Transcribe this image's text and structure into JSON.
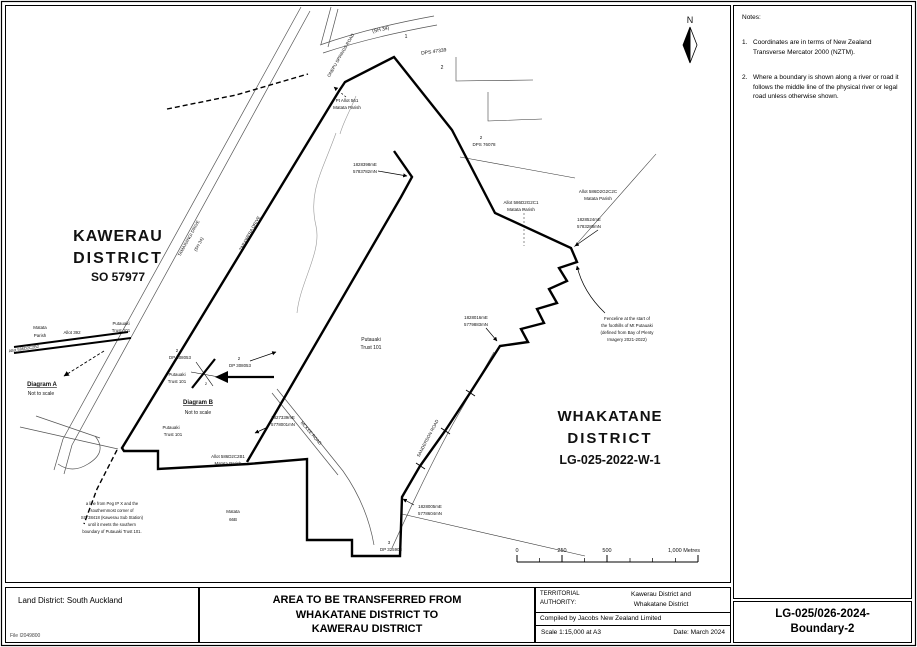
{
  "notes_panel": {
    "title": "Notes:",
    "notes": [
      {
        "num": "1.",
        "text": "Coordinates are in terms of New Zealand Transverse Mercator 2000 (NZTM)."
      },
      {
        "num": "2.",
        "text": "Where a boundary is shown along a river or road it follows the middle line of the physical river or legal road unless otherwise shown."
      }
    ]
  },
  "sheet_ref": {
    "line1": "LG-025/026-2024-",
    "line2": "Boundary-2"
  },
  "title_block": {
    "land_district": "Land District: South Auckland",
    "file_ref": "File I2049800",
    "title_line1": "AREA TO BE TRANSFERRED FROM",
    "title_line2": "WHAKATANE DISTRICT TO",
    "title_line3": "KAWERAU DISTRICT",
    "ta_label_l1": "TERRITORIAL",
    "ta_label_l2": "AUTHORITY:",
    "ta_value_l1": "Kawerau District and",
    "ta_value_l2": "Whakatane District",
    "compiled_by": "Compiled by Jacobs New Zealand Limited",
    "scale_label": "Scale  1:15,000   at A3",
    "date_label": "Date: March 2024"
  },
  "map": {
    "labels": {
      "lot1": "1",
      "sh34": "(SH 34)",
      "onepu": "ONEPU SPRINGS ROAD",
      "dps47339": "DPS 47339",
      "lot2": "2",
      "dps76078_num": "2",
      "dps76078": "DPS 76078",
      "pt_allot_l1": "Pt Allot 561",
      "pt_allot_l2": "Matata Parish",
      "coord_ne_e": "1828398mE",
      "coord_ne_n": "5783782mN",
      "allot_c1_l1": "Allot 586D2G2C1",
      "allot_c1_l2": "Matata Parish",
      "allot_c2_l1": "Allot 586D2G2C2C",
      "allot_c2_l2": "Matata Parish",
      "coord_e_e": "1828524mE",
      "coord_e_n": "5783288mN",
      "fence_l1": "Fenceline at the start of",
      "fence_l2": "the foothills of Mt Putauaki",
      "fence_l3": "(defined from Bay of Plenty",
      "fence_l4": "Imagery 2021-2022)",
      "coord_mid_e": "1828016mE",
      "coord_mid_n": "5779883mN",
      "putauaki_c_l1": "Putauaki",
      "putauaki_c_l2": "Trust 101",
      "tamarangi_l1": "TAMARANGI DRIVE",
      "tamarangi_l2": "(SH 34)",
      "tarawera": "TARAWERA DRIVE",
      "kawerau_l1": "KAWERAU",
      "kawerau_l2": "DISTRICT",
      "kawerau_l3": "SO 57977",
      "matata_l_l1": "Matata",
      "matata_l_l2": "Parish",
      "allot392": "Allot 392",
      "putauaki_w_l1": "Putauaki",
      "putauaki_w_l2": "Trust 101",
      "allot_b2": "Allot 586D2C2B2",
      "diagram_a": "Diagram A",
      "diagram_a_sub": "Not to scale",
      "diagram_b": "Diagram B",
      "diagram_b_sub": "Not to scale",
      "dp_b_num": "2",
      "dp_b": "DP 308053",
      "dp_m_num": "2",
      "dp_m": "DP 308053",
      "inset_num": "2",
      "putauaki_b_l1": "Putauaki",
      "putauaki_b_l2": "Trust 101",
      "coord_w_e": "1827339mE",
      "coord_w_n": "5778001mN",
      "mckee": "MCKEE ROAD",
      "sanderson": "SANDERSON ROAD",
      "putauaki_s_l1": "Putauaki",
      "putauaki_s_l2": "Trust 101",
      "allot_b1_l1": "Allot 586D2C2B1",
      "allot_b1_l2": "Matata Parish",
      "peg_l1": "a line from Peg IP X and the",
      "peg_l2": "southernmost corner of",
      "peg_l3": "SO 38418 (Kawerau Sub Station)",
      "peg_l4": "until it meets the southern",
      "peg_l5": "boundary of Putauaki Trust 101.",
      "matata66_l1": "Matata",
      "matata66_l2": "66B",
      "lot3": "3",
      "dp325908": "DP 325908",
      "coord_s_e": "1828005mE",
      "coord_s_n": "5778604mN",
      "whaka_l1": "WHAKATANE",
      "whaka_l2": "DISTRICT",
      "whaka_l3": "LG-025-2022-W-1",
      "north": "N",
      "scale0": "0",
      "scale250": "250",
      "scale500": "500",
      "scale1000": "1,000 Metres"
    }
  }
}
